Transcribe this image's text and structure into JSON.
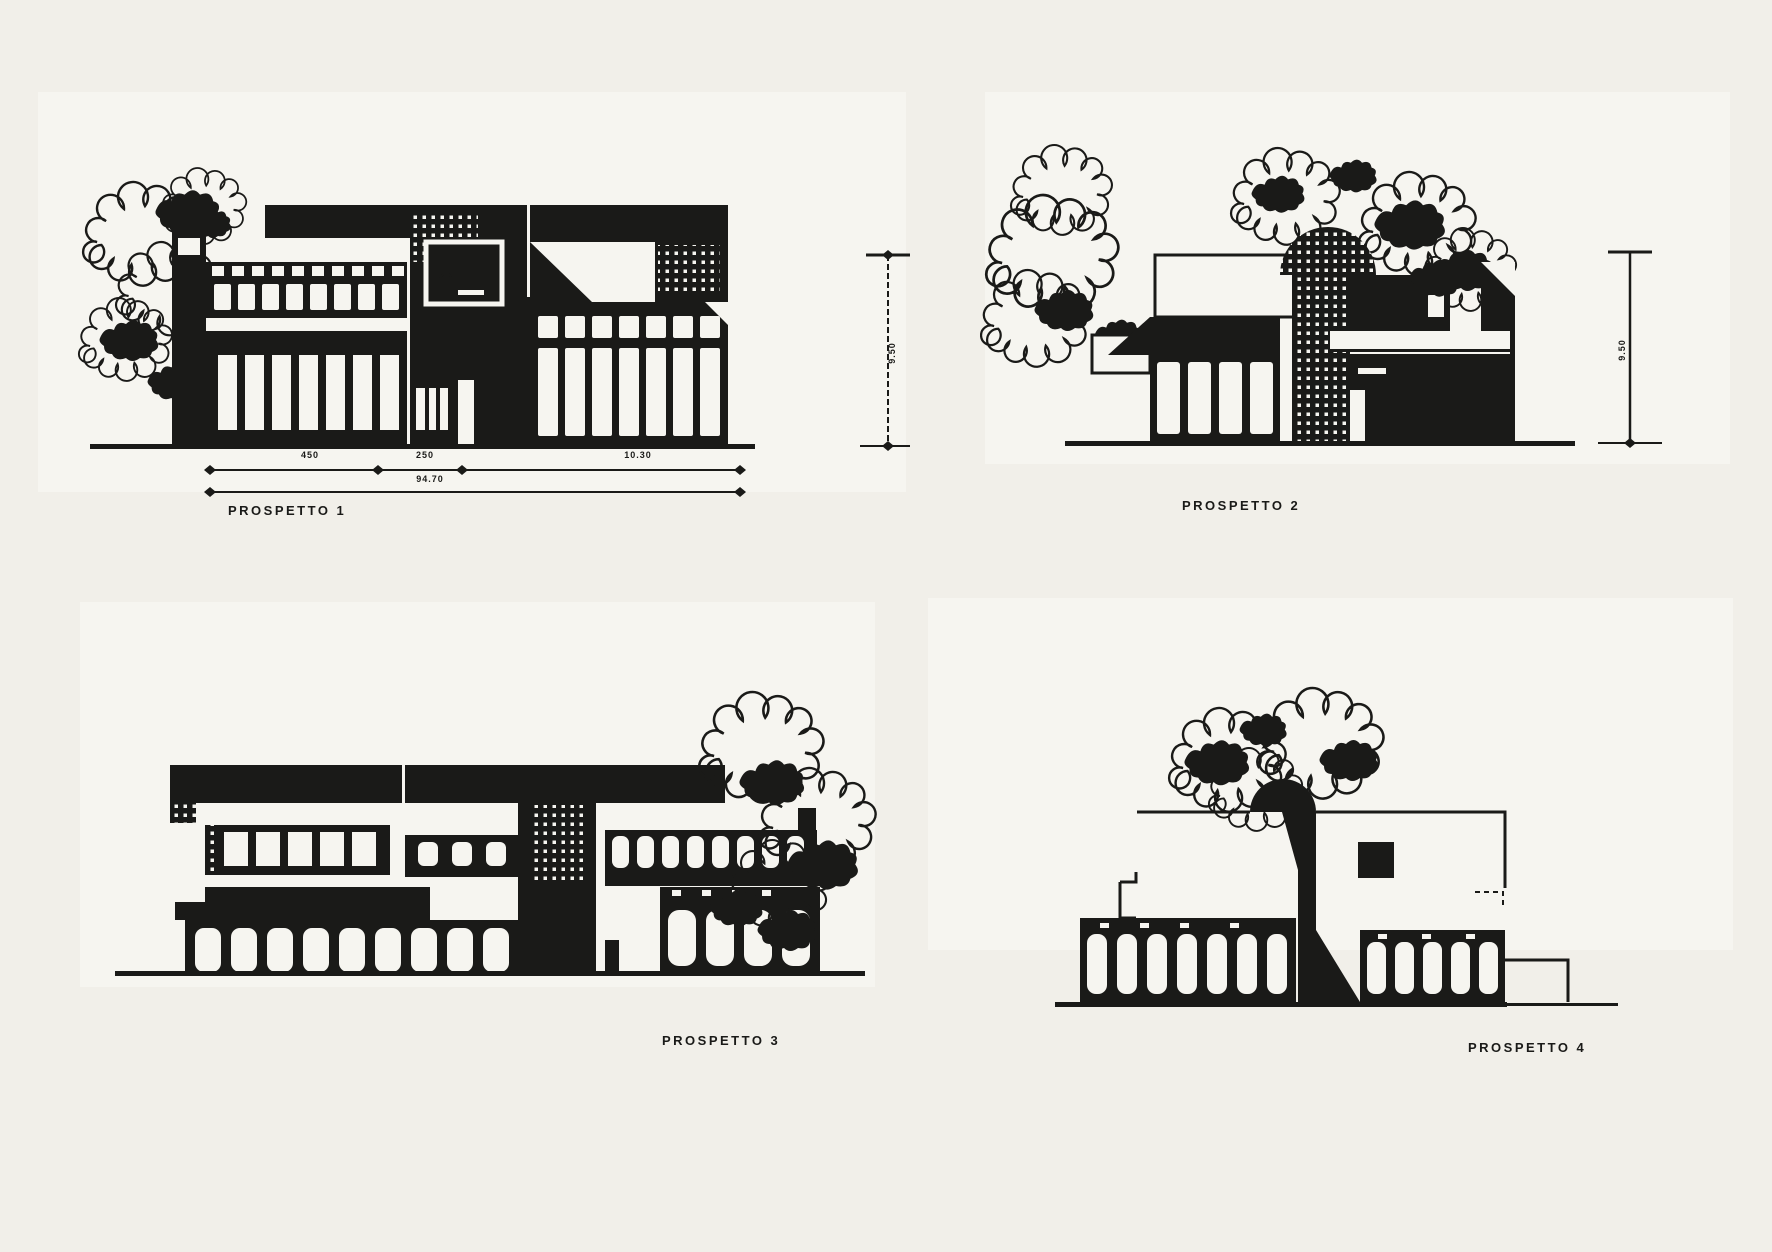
{
  "page": {
    "background": "#f1efe9",
    "panel_background": "#f6f5f0",
    "ink": "#1a1a18"
  },
  "elevations": [
    {
      "label": "PROSPETTO 1",
      "dimensions": {
        "segments": [
          "450",
          "250",
          "10.30"
        ],
        "total": "94.70",
        "height": "9.50"
      }
    },
    {
      "label": "PROSPETTO 2",
      "dimensions": {
        "height": "9.50"
      }
    },
    {
      "label": "PROSPETTO 3"
    },
    {
      "label": "PROSPETTO 4"
    }
  ]
}
